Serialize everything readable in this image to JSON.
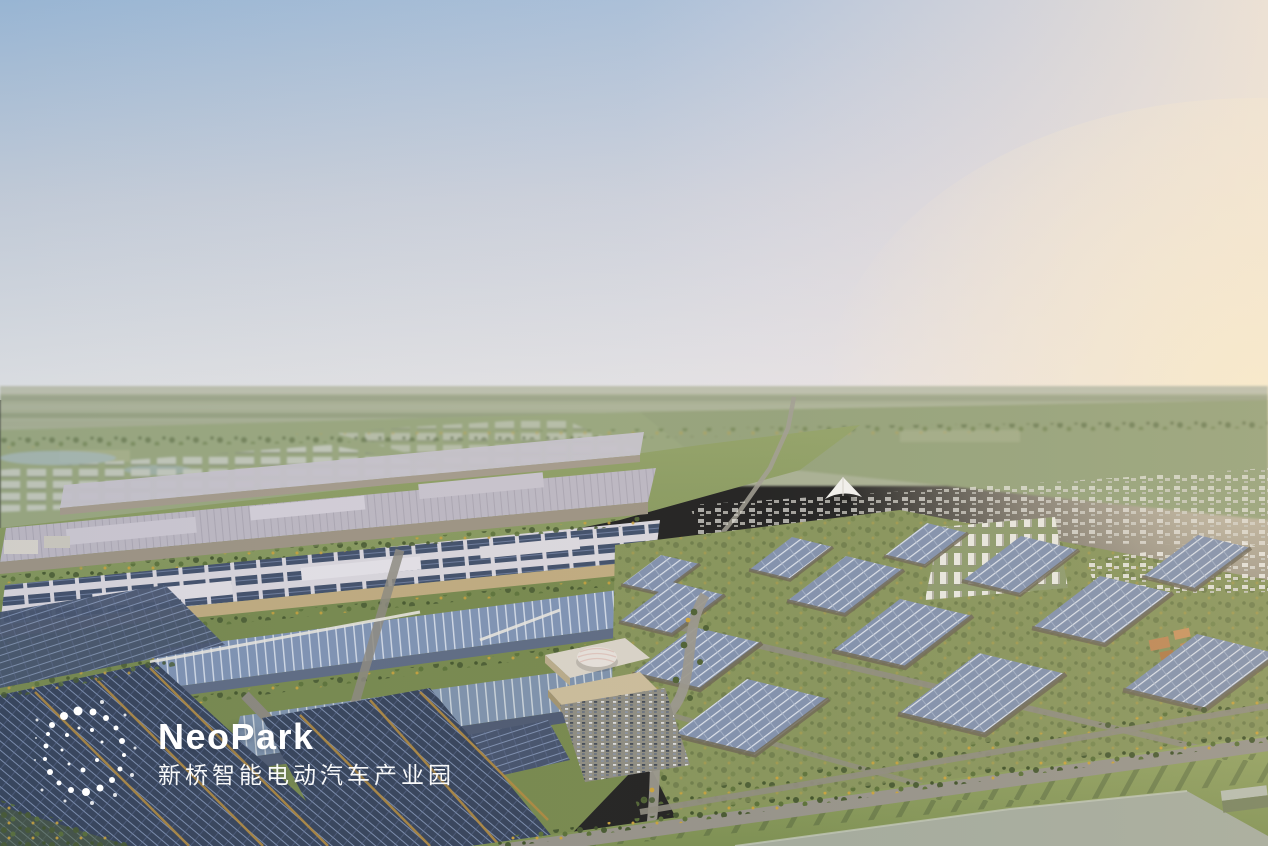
{
  "logo": {
    "wordmark": "NeoPark",
    "subtitle": "新桥智能电动汽车产业园",
    "color": "#ffffff"
  },
  "scene": {
    "description_colors": {
      "sky-top": "#9cb9d7",
      "sky-mid": "#c7cfdb",
      "sky-horizon": "#e3e4e6",
      "sky-pink": "#f2e6da",
      "sky-warm": "#f9ecce",
      "haze": "#c2c4b4",
      "field-light": "#b0b79f",
      "field-dark": "#93a07e",
      "grass": "#8a9a5f",
      "grass-deep": "#77894e",
      "tree": "#475931",
      "tree-gold": "#c9a23c",
      "roof-light": "#bdb8c3",
      "roof-pale": "#d8d5dc",
      "eave-tan": "#c2ac7e",
      "wall-tan": "#cfc5a8",
      "wall-shadow": "#6e6754",
      "solar-navy": "#3d4b64",
      "solar-grid": "#8799ba",
      "solar-mid": "#8291ad",
      "glass-blue": "#7f93b4",
      "road": "#96938a",
      "city-white": "#e9e7e1",
      "slab": "#a4ab9e",
      "gold": "#b28a40",
      "logo-white": "#ffffff"
    }
  }
}
